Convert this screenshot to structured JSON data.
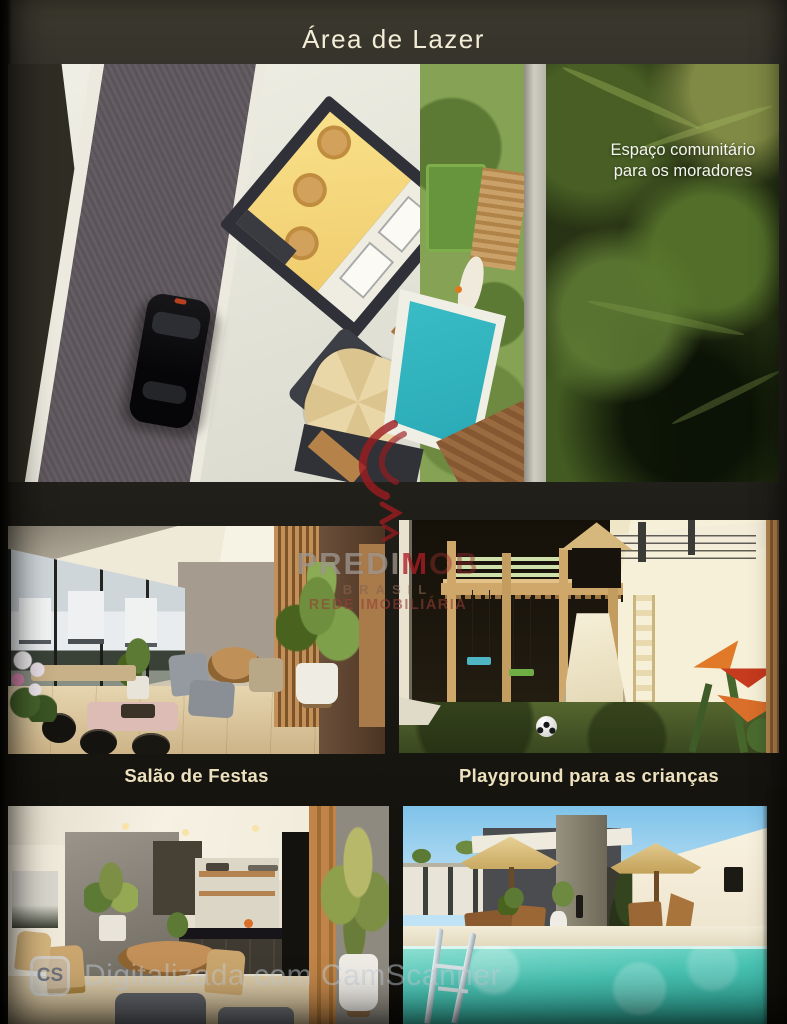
{
  "page": {
    "title": "Área de Lazer"
  },
  "hero": {
    "annotation_line1": "Espaço comunitário",
    "annotation_line2": "para os moradores"
  },
  "captions": {
    "salao": "Salão de Festas",
    "playground": "Playground para as crianças"
  },
  "watermark_brand": {
    "word_part1": "PREDI",
    "word_part2": "M",
    "word_part3": "OB",
    "line2": "BRASIL",
    "line3": "REDE IMOBILIÁRIA",
    "accent_color": "#a61e25"
  },
  "watermark_scanner": {
    "icon_label": "CS",
    "text": "Digitalizada com CamScanner"
  },
  "colors": {
    "title_text": "#f3ecd6",
    "caption_text": "#ece0bd",
    "pool_water": "#45c4c2",
    "lawn_green": "#7fa050",
    "brand_red": "#a61e25"
  }
}
